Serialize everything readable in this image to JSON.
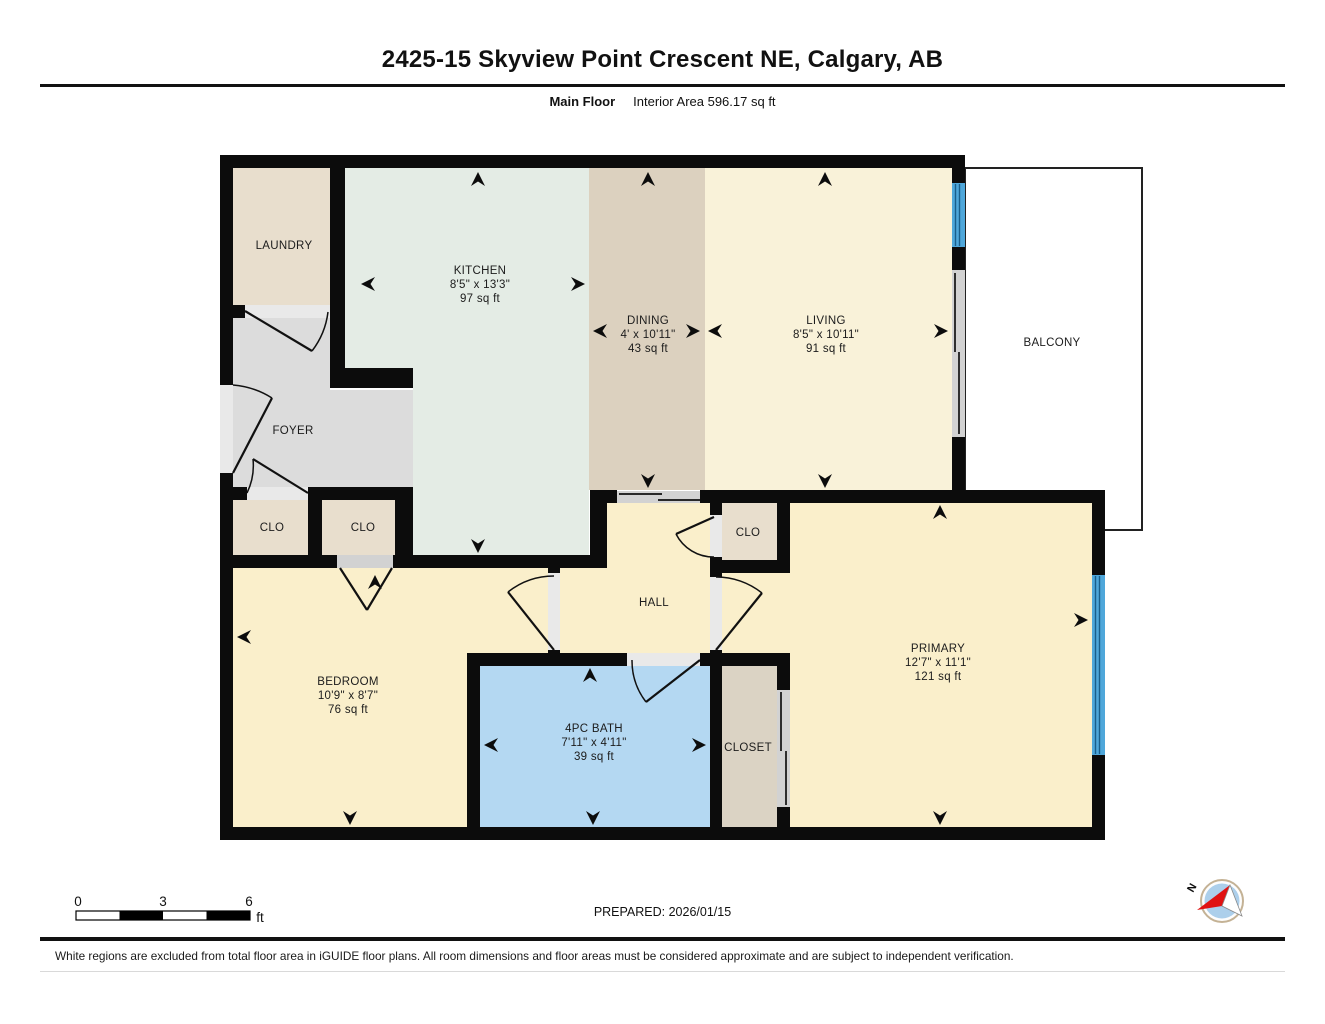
{
  "header": {
    "title": "2425-15 Skyview Point Crescent NE, Calgary, AB",
    "floor_label": "Main Floor",
    "area_label": "Interior Area 596.17 sq ft"
  },
  "rooms": {
    "laundry": {
      "name": "LAUNDRY"
    },
    "kitchen": {
      "name": "KITCHEN",
      "dims": "8'5\" x 13'3\"",
      "area": "97 sq ft"
    },
    "dining": {
      "name": "DINING",
      "dims": "4' x 10'11\"",
      "area": "43 sq ft"
    },
    "living": {
      "name": "LIVING",
      "dims": "8'5\" x 10'11\"",
      "area": "91 sq ft"
    },
    "balcony": {
      "name": "BALCONY"
    },
    "foyer": {
      "name": "FOYER"
    },
    "clo_foyer": {
      "name": "CLO"
    },
    "clo_bedroom": {
      "name": "CLO"
    },
    "clo_hall": {
      "name": "CLO"
    },
    "hall": {
      "name": "HALL"
    },
    "bedroom": {
      "name": "BEDROOM",
      "dims": "10'9\" x 8'7\"",
      "area": "76 sq ft"
    },
    "bath": {
      "name": "4PC BATH",
      "dims": "7'11\" x 4'11\"",
      "area": "39 sq ft"
    },
    "closet": {
      "name": "CLOSET"
    },
    "primary": {
      "name": "PRIMARY",
      "dims": "12'7\" x 11'1\"",
      "area": "121 sq ft"
    }
  },
  "scale_bar": {
    "tick0": "0",
    "tick1": "3",
    "tick2": "6",
    "unit": "ft"
  },
  "compass": {
    "north_label": "N"
  },
  "footer": {
    "prepared": "PREPARED: 2026/01/15",
    "disclaimer": "White regions are excluded from total floor area in iGUIDE floor plans. All room dimensions and floor areas must be considered approximate and are subject to independent verification."
  },
  "colors": {
    "wall": "#0c0c0c",
    "kitchen": "#e4ece5",
    "dining": "#dcd1bf",
    "living": "#f9f2d9",
    "cream": "#faefcb",
    "foyer": "#dcdcdc",
    "beige": "#e8decd",
    "closet": "#dbd3c4",
    "bath": "#b4d8f2",
    "balcony": "#ffffff",
    "window": "#4fa7da",
    "window_line": "#1a5e8a",
    "door": "#d2d2d2",
    "threshold": "#e9e9e9",
    "compass_disc": "#accfeb",
    "compass_red": "#e01212",
    "compass_ring": "#c4b295"
  }
}
